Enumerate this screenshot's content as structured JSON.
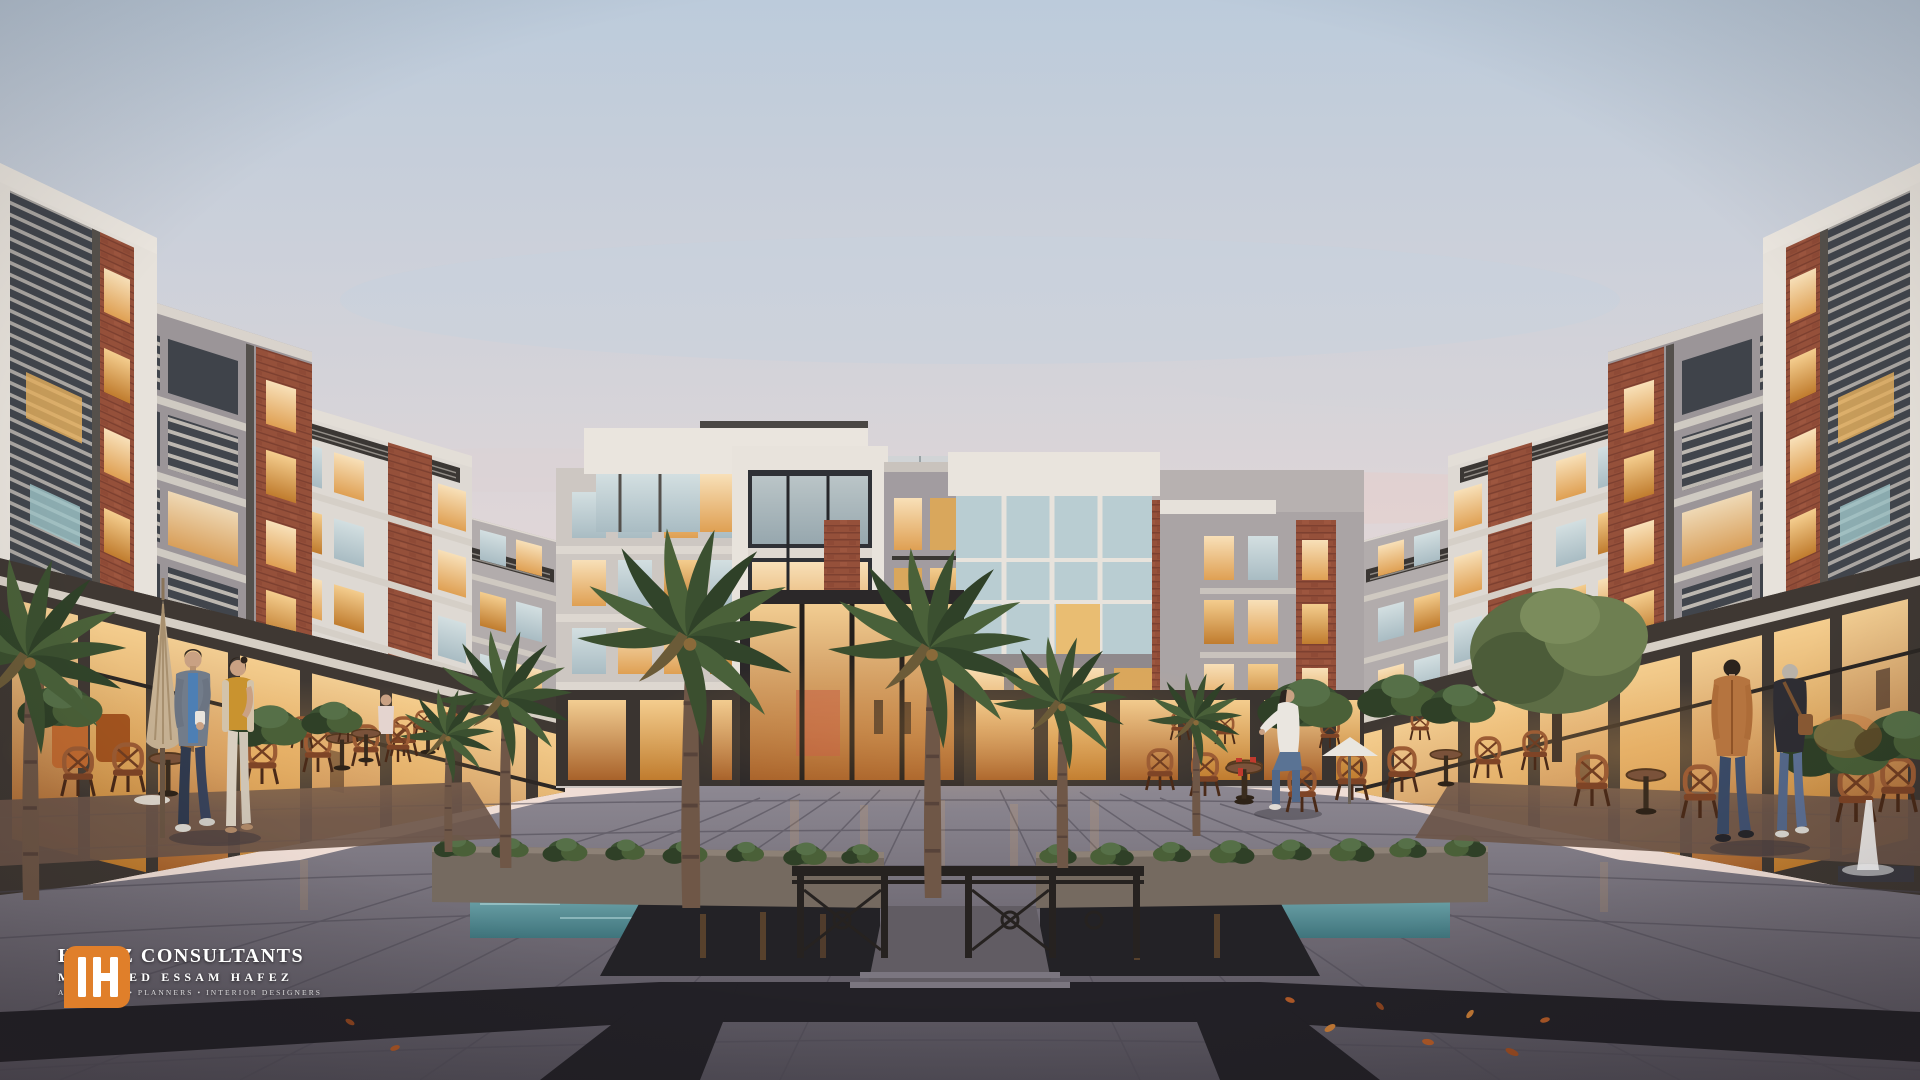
{
  "brand": {
    "monogram": "IH",
    "name": "HAFEZ CONSULTANTS",
    "person": "MOHAMED ESSAM HAFEZ",
    "tagline": "ARCHITECTS • PLANNERS • INTERIOR DESIGNERS",
    "accent_color": "#E07F2A"
  },
  "icons": {
    "brand_monogram": "IH"
  },
  "palette": {
    "sky_top": "#BFCEDD",
    "sky_mid": "#DCD8DC",
    "sky_horizon": "#F0DED6",
    "facade_white": "#E8E3DC",
    "facade_gray": "#9E989B",
    "brick": "#95503A",
    "window_warm": "#F2CB8A",
    "window_cool": "#C4D5D8",
    "glass_dark": "#3C4046",
    "plaza": "#6E6A73",
    "plaza_band": "#232127",
    "terracotta": "#6F5142",
    "foliage": "#44573A",
    "rattan": "#9C5C34",
    "water": "#4F8A92"
  }
}
